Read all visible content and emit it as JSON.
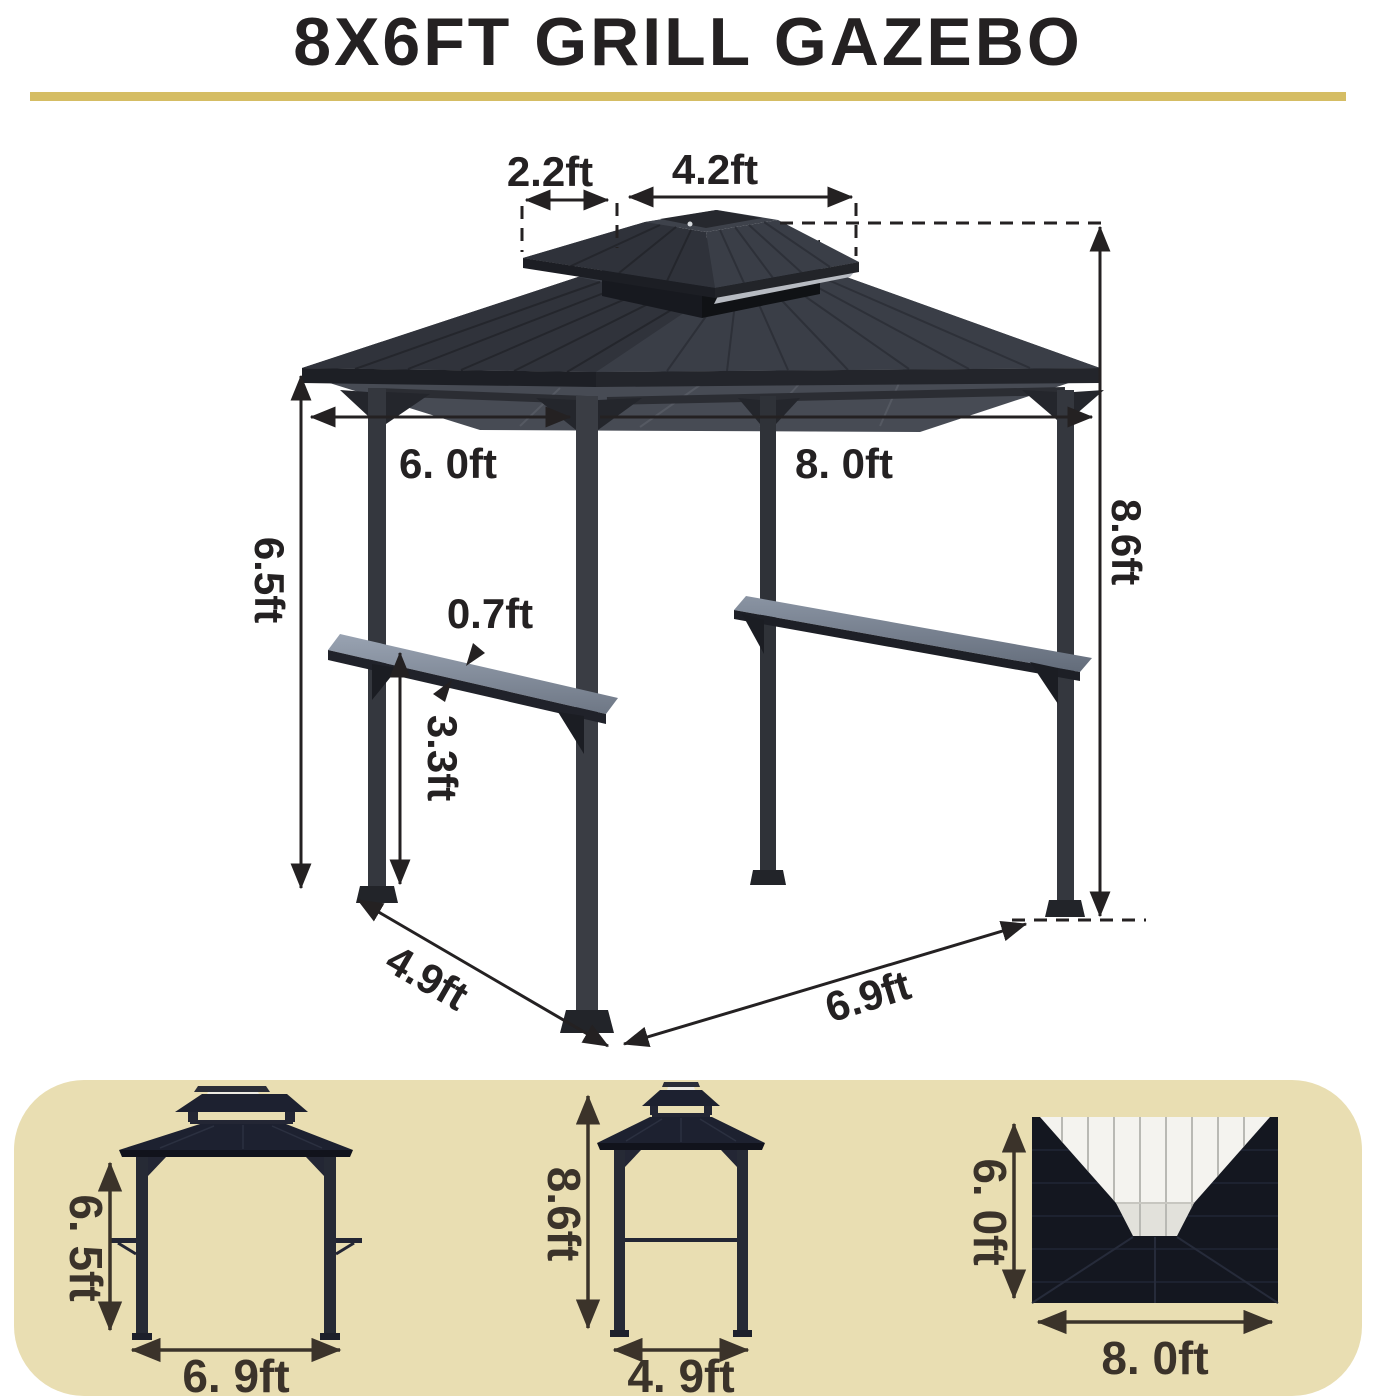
{
  "title": "8X6FT GRILL GAZEBO",
  "colors": {
    "accent_bar": "#d5bd64",
    "panel_bg": "#e9deb2",
    "ink_main": "#242122",
    "ink_views": "#3b332a",
    "roof_dark_main": "#33363e",
    "roof_dark_views": "#1d2130",
    "shelf_top": "#8d97a6",
    "vent_white": "#f4f3ef"
  },
  "main_diagram": {
    "labels": {
      "cupola_side": "2.2ft",
      "cupola_top": "4.2ft",
      "frame_depth": "6. 0ft",
      "frame_width": "8. 0ft",
      "post_height": "6.5ft",
      "total_height": "8.6ft",
      "shelf_depth": "0.7ft",
      "shelf_height": "3.3ft",
      "base_depth": "4.9ft",
      "base_width": "6.9ft"
    }
  },
  "views": {
    "front": {
      "height": "6. 5ft",
      "width": "6. 9ft"
    },
    "side": {
      "height": "8.6ft",
      "width": "4. 9ft"
    },
    "top": {
      "depth": "6. 0ft",
      "width": "8. 0ft"
    }
  }
}
